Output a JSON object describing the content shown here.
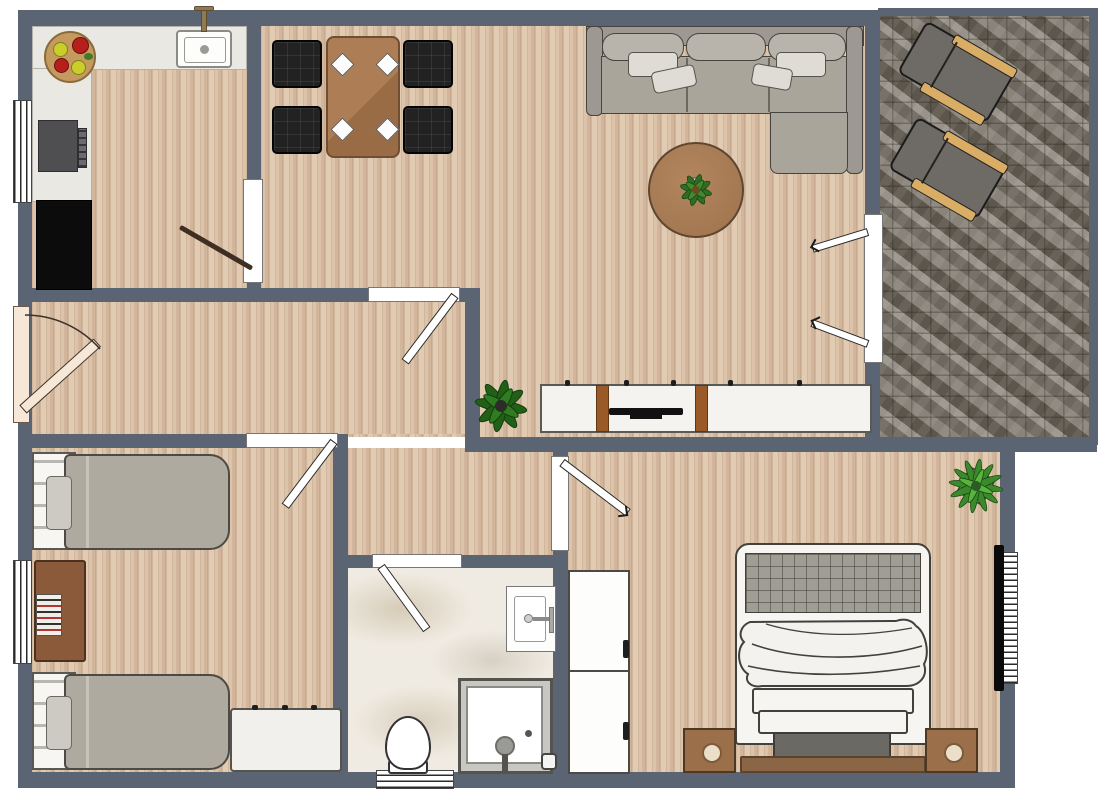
{
  "plan": {
    "title": "apartment-floor-plan",
    "colors": {
      "wall": "#5a6473",
      "wood_floor": "#d7bda3",
      "stone_patio": "#7b756c",
      "marble_bath": "#f0ebe2",
      "counter_white": "#eae8e2",
      "table_brown": "#a5764f",
      "sofa_gray": "#a9a59b",
      "entry_door_cream": "#f6e7d7",
      "rug_brown": "#a97c55",
      "plant_green": "#2f6d24",
      "lounger_rail_tan": "#d9ad66"
    },
    "rooms": [
      {
        "name": "kitchen",
        "furniture": [
          "l-shaped-counter",
          "sink-with-faucet",
          "stove",
          "black-counter",
          "fruit-bowl"
        ],
        "windows": 1,
        "doors": 1
      },
      {
        "name": "dining-area",
        "furniture": [
          "dining-table",
          "chair x4",
          "plate x4"
        ]
      },
      {
        "name": "living-room",
        "furniture": [
          "corner-sofa",
          "pillow x4",
          "round-rug",
          "rug-plant",
          "tv-sideboard",
          "floor-plant"
        ],
        "doors": 2
      },
      {
        "name": "patio",
        "furniture": [
          "lounge-chair x2"
        ],
        "floor": "stone"
      },
      {
        "name": "hallway",
        "furniture": [],
        "doors": [
          "entry-door",
          "living-room-door",
          "bedroom-door"
        ]
      },
      {
        "name": "small-bedroom",
        "furniture": [
          "single-bed x2",
          "desk-with-books",
          "dresser"
        ],
        "windows": 1
      },
      {
        "name": "bathroom",
        "furniture": [
          "wall-sink",
          "shower-cabin",
          "toilet"
        ],
        "windows": 1,
        "doors": 1
      },
      {
        "name": "master-bedroom",
        "furniture": [
          "double-bed",
          "wardrobe",
          "nightstand x2",
          "bench",
          "wall-tv",
          "plant"
        ],
        "windows": 1,
        "doors": 1
      }
    ],
    "counts": {
      "windows": 5,
      "interior_doors": 6,
      "exterior_doors": 2
    }
  }
}
